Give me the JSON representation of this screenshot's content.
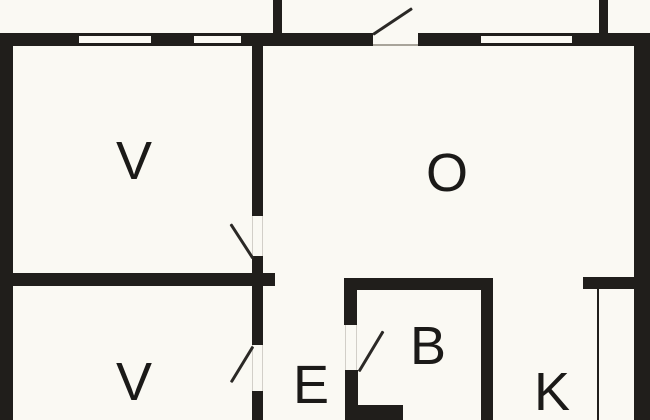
{
  "title": "Floor plan",
  "colors": {
    "wall": "#201e1b",
    "paper": "#faf9f3",
    "jamb": "#d2cfc8",
    "threshold": "#a8a49a",
    "leaf": "#2b2926",
    "label": "#1b1a18"
  },
  "rooms": {
    "v1": {
      "label": "V"
    },
    "o": {
      "label": "O"
    },
    "v2": {
      "label": "V"
    },
    "e": {
      "label": "E"
    },
    "b": {
      "label": "B"
    },
    "k": {
      "label": "K"
    }
  }
}
